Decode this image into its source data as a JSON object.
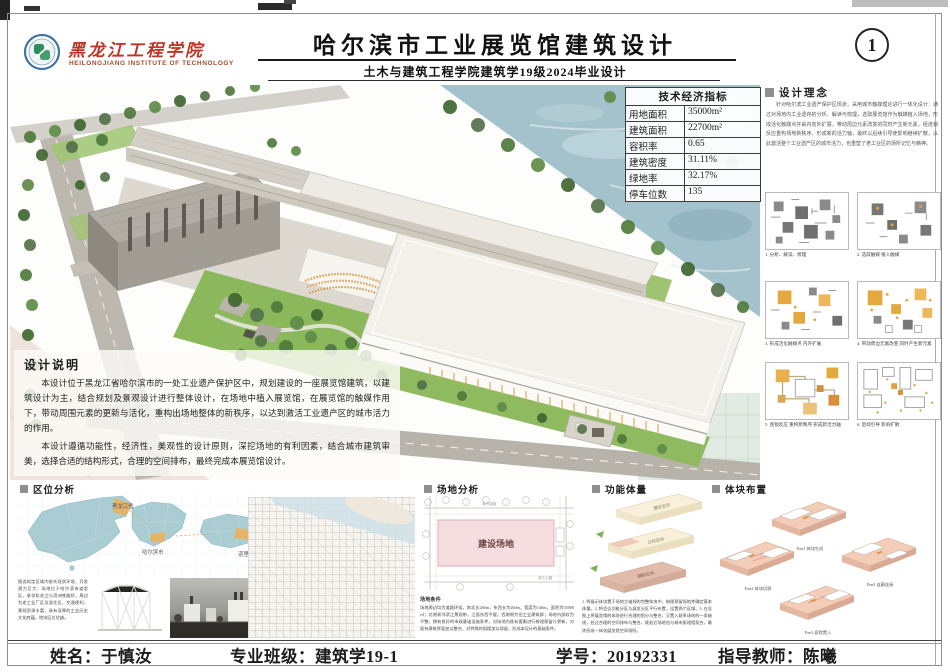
{
  "header": {
    "school_name": "黑龙江工程学院",
    "school_name_en": "HEILONGJIANG  INSTITUTE  OF  TECHNOLOGY",
    "title": "哈尔滨市工业展览馆建筑设计",
    "subtitle": "土木与建筑工程学院建筑学19级2024毕业设计",
    "sheet_number": "1"
  },
  "indicators": {
    "title": "技术经济指标",
    "rows": [
      {
        "label": "用地面积",
        "value": "35000m²"
      },
      {
        "label": "建筑面积",
        "value": "22700m²"
      },
      {
        "label": "容积率",
        "value": "0.65"
      },
      {
        "label": "建筑密度",
        "value": "31.11%"
      },
      {
        "label": "绿地率",
        "value": "32.17%"
      },
      {
        "label": "停车位数",
        "value": "135"
      }
    ]
  },
  "design_description": {
    "title": "设计说明",
    "paragraph1": "本设计位于黑龙江省哈尔滨市的一处工业遗产保护区中，规划建设的一座展览馆建筑，以建筑设计为主，结合规划及景观设计进行整体设计，在场地中植入展览馆，在展览馆的触媒作用下，带动周围元素的更新与活化，重构出场地整体的新秩序，以达到激活工业遗产区的城市活力的作用。",
    "paragraph2": "本设计遵循功能性，经济性，美观性的设计原则，深挖场地的有利因素，结合城市建筑审美，选择合适的结构形式，合理的空间排布，最终完成本展览馆设计。"
  },
  "design_concept": {
    "title": "设计理念",
    "text": "针对哈尔滨工业遗产保护区现状，采用城市触媒理论进行一体化设计：通过对场地内工业遗存的分析、解读与梳理，选取展览馆作为触媒植入场地，形成活化触媒点并由内向外扩展，带动周边元素改变的同时产生新元素，经连锁反应重构场地新秩序、形成新的活力轴，最终以后续引导使影响继续扩散，以此激活整个工业遗产区的城市活力，也重塑了老工业区的场所记忆与精神。",
    "diagrams": [
      {
        "caption": "1. 分析、解读、梳理"
      },
      {
        "caption": "2. 选取触媒 植入触媒"
      },
      {
        "caption": "3. 形成活化触媒点 内外扩展"
      },
      {
        "caption": "4. 带动周边元素改变 同时产生新元素"
      },
      {
        "caption": "5. 连锁反应 重构新秩序 形成新活力轴"
      },
      {
        "caption": "6. 后续引导 影响扩散"
      }
    ]
  },
  "location": {
    "title": "区位分析",
    "map_labels": {
      "province": "黑龙江省",
      "city": "哈尔滨市",
      "district": "道里区"
    },
    "note": "图选拟定区域内依托现状环境，开发潜力巨大：场地位于哈尔滨市道里区，紧邻松花江与滨洲铁路桥，周边为老工业厂区及居住区，交通便利，景观资源丰富，具有深厚的工业历史文化底蕴，地块区位优越。"
  },
  "site": {
    "title": "场地分析",
    "site_label": "建设场地",
    "road_label_top": "城市道路",
    "road_label_right": "滨江公路",
    "note_title": "场地条件",
    "note": "场地周边均为道路环绕，南北长260m，东西长为260m，宽度为140m，面积为35000㎡；北侧紧邻滨江景观带，江面东西平缓，西南侧为旧工业建筑群；场地内部较为平整，拥有良好的市政基础设施条件，对场地内既有要素进行梳理保留与更新，对既有建筑界面加以整合，对特殊的肌理加以保留，形成本设计的基础条件。"
  },
  "massing_function": {
    "title": "功能体量",
    "block_labels": [
      "展览空间",
      "公共空间",
      "辅助空间"
    ],
    "notes": "1. 将展示体块置于场地主轴线的完整体块中，梳理预留场地并确定基本体量。2. 将会议功能分区与展览分区平行布置，设置两个区域。3. 在总图上将展览馆的体块进行合理的划分与整合，又置入联系场地的一条轴线，经过合理的空间排布与整合，既贴近场地也与城市肌理相契合，最终形成一体化展览馆空间场所。"
  },
  "massing_layout": {
    "title": "体块布置",
    "captions": [
      "Part1 体块生成",
      "Part2 体块切割",
      "Part3 庭院置入",
      "Part4 连廊连接"
    ]
  },
  "footer": {
    "name_label": "姓名：",
    "name": "于慎汝",
    "class_label": "专业班级：",
    "class_value": "建筑学19-1",
    "id_label": "学号：",
    "id_value": "20192331",
    "teacher_label": "指导教师：",
    "teacher": "陈曦"
  },
  "colors": {
    "brand_red": "#bf3524",
    "highlight_orange": "#e0a33c",
    "water_blue": "#a3c2cc",
    "lawn_green": "#8cb85c",
    "site_pink": "#f6dde0"
  }
}
